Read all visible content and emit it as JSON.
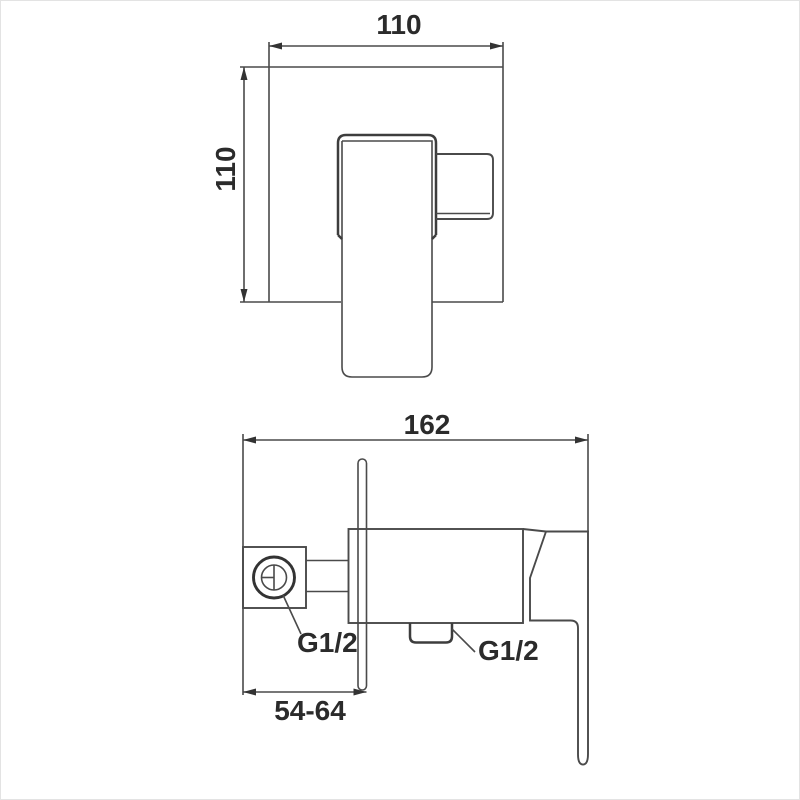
{
  "drawing": {
    "type": "technical-dimension-drawing",
    "line_color": "#4a4a4a",
    "text_color": "#2b2b2b",
    "background_color": "#ffffff",
    "front_view": {
      "width": "110",
      "height": "110"
    },
    "side_view": {
      "depth": "162",
      "wall_distance": "54-64",
      "inlet_thread": "G1/2",
      "outlet_thread": "G1/2"
    }
  }
}
